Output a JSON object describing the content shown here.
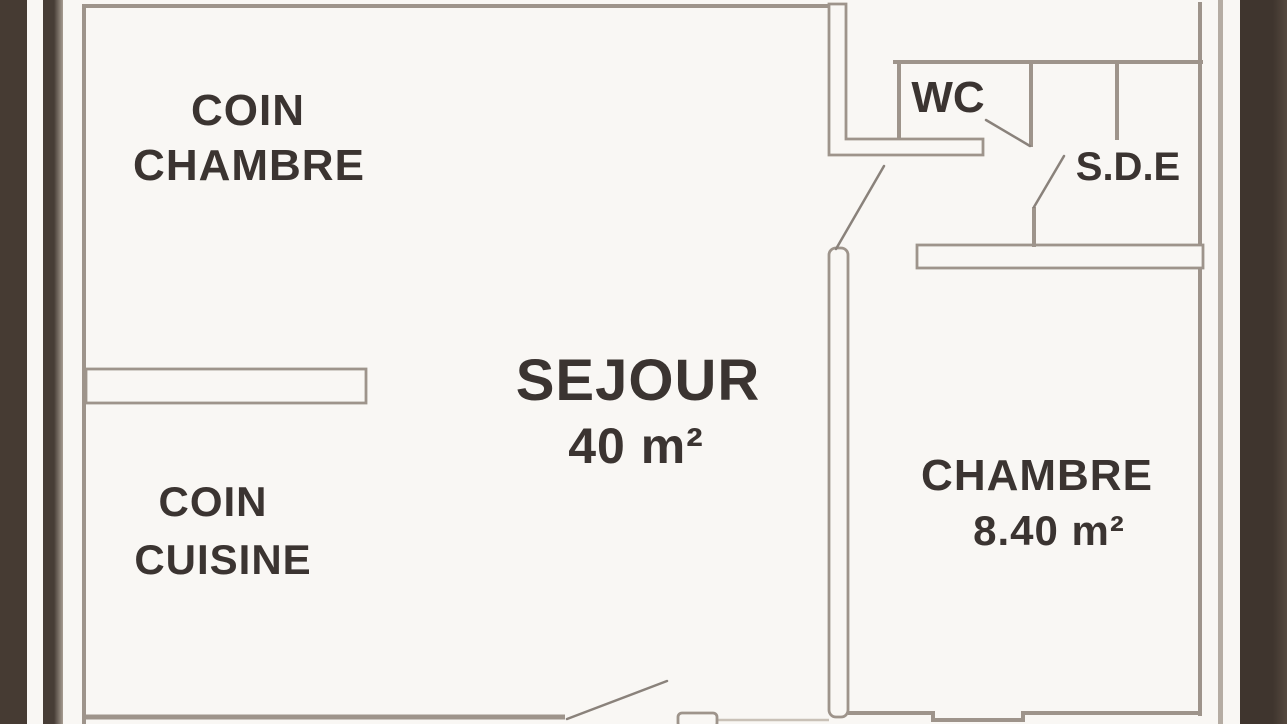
{
  "document": {
    "type": "apartment-floor-plan",
    "colors": {
      "paper": "#f9f7f4",
      "ink": "#3b3431",
      "wall": "#9e948b",
      "wall_light": "#c9c1b7",
      "frame_dark": "#463b33",
      "page_edge": "#b5aca3"
    }
  },
  "rooms": {
    "coin_chambre": {
      "line1": "COIN",
      "line2": "CHAMBRE"
    },
    "sejour": {
      "name": "SEJOUR",
      "area": "40 m²"
    },
    "coin_cuisine": {
      "line1": "COIN",
      "line2": "CUISINE"
    },
    "chambre": {
      "name": "CHAMBRE",
      "area": "8.40 m²"
    },
    "wc": {
      "name": "WC"
    },
    "sde": {
      "name": "S.D.E"
    }
  }
}
